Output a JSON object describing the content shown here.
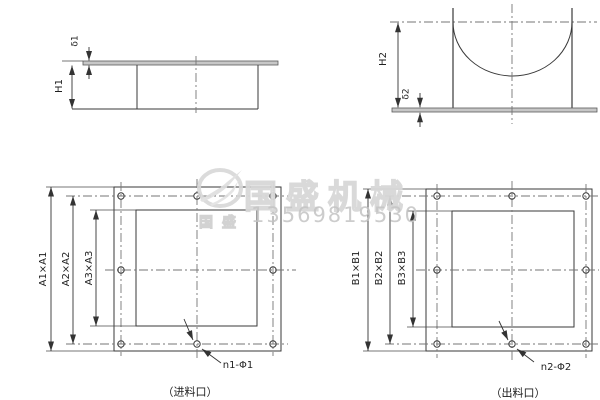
{
  "title": "flange dimension drawing",
  "drawing": {
    "top_left_view": {
      "thickness_label": "δ1",
      "height_label": "H1"
    },
    "top_right_view": {
      "height_label": "H2",
      "thickness_label": "δ2"
    },
    "inlet_flange": {
      "outer_dim": "A1×A1",
      "bolt_circle_dim": "A2×A2",
      "opening_dim": "A3×A3",
      "holes_label": "n1-Φ1",
      "caption": "（进料口）"
    },
    "outlet_flange": {
      "outer_dim": "B1×B1",
      "bolt_circle_dim": "B2×B2",
      "opening_dim": "B3×B3",
      "holes_label": "n2-Φ2",
      "caption": "（出料口）"
    }
  },
  "watermark": {
    "brand": "国盛机械",
    "brand_small": "国盛",
    "phone": "13569819530",
    "logo_icon": "bird-in-ring"
  },
  "colors": {
    "background": "#ffffff",
    "line": "#3a3a3a",
    "centerline": "#767676",
    "plate_fill": "#c7c7c7",
    "watermark_gray": "#d7d7d7"
  }
}
